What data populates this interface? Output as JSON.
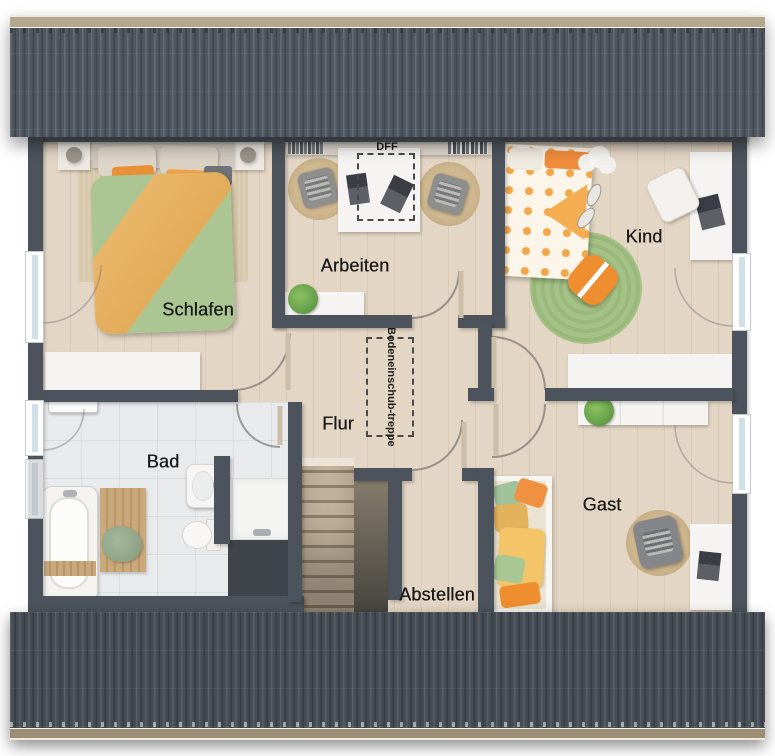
{
  "floorplan": {
    "rooms": [
      {
        "id": "schlafen",
        "label": "Schlafen"
      },
      {
        "id": "arbeiten",
        "label": "Arbeiten"
      },
      {
        "id": "kind",
        "label": "Kind"
      },
      {
        "id": "flur",
        "label": "Flur"
      },
      {
        "id": "bad",
        "label": "Bad"
      },
      {
        "id": "gast",
        "label": "Gast"
      },
      {
        "id": "abstellen",
        "label": "Abstellen"
      }
    ],
    "annotations": {
      "roof_window_label": "DFF",
      "attic_stair_line1": "Bodeneinschub-",
      "attic_stair_line2": "treppe"
    },
    "colors": {
      "roof_top": "#4f5660",
      "roof_bottom": "#464c54",
      "ridge": "#b3a78c",
      "gutter": "#9b8e74",
      "wall": "#4d535c",
      "wood_floor": "#e3d6c4",
      "tile_floor": "#e8eaec",
      "furniture_white": "#f5f4f2",
      "duvet_green": "#abc693",
      "duvet_orange": "#e8b568",
      "accent_orange": "#ef8e35",
      "rug_green": "#a5c286",
      "rug_jute": "#c7ae85",
      "window_glass": "#cfe0e8"
    }
  }
}
